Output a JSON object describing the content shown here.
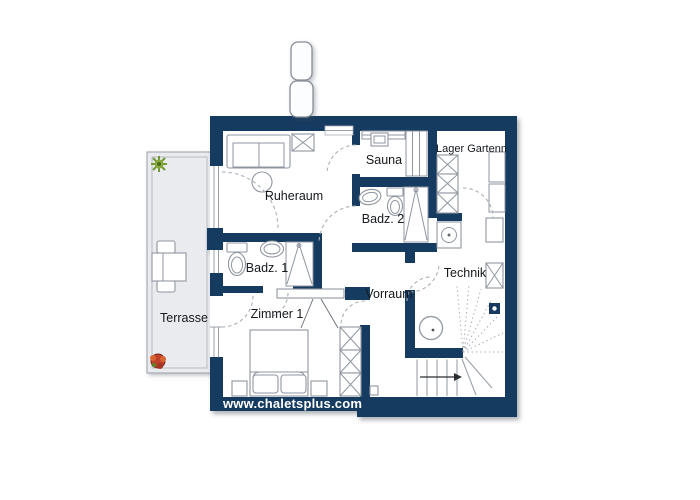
{
  "branding": {
    "website": "www.chaletsplus.com"
  },
  "rooms": {
    "terrasse": {
      "label": "Terrasse"
    },
    "ruheraum": {
      "label": "Ruheraum"
    },
    "sauna": {
      "label": "Sauna"
    },
    "badz1": {
      "label": "Badz. 1"
    },
    "badz2": {
      "label": "Badz. 2"
    },
    "zimmer1": {
      "label": "Zimmer 1"
    },
    "vorraum": {
      "label": "Vorraum"
    },
    "technik": {
      "label": "Technik"
    },
    "lager": {
      "label": "Lager Gartenm"
    }
  },
  "colors": {
    "wall": "#173a60",
    "terrace_fill": "#e9ebee",
    "terrace_border": "#9aa1a9",
    "floor": "#ffffff",
    "fixture_line": "#8f96a0",
    "dashed_line": "#aab0b8",
    "label_text": "#15181c",
    "website_text": "#ffffff",
    "plant_green": "#6f9a2f",
    "plant_red": "#bf4129"
  }
}
